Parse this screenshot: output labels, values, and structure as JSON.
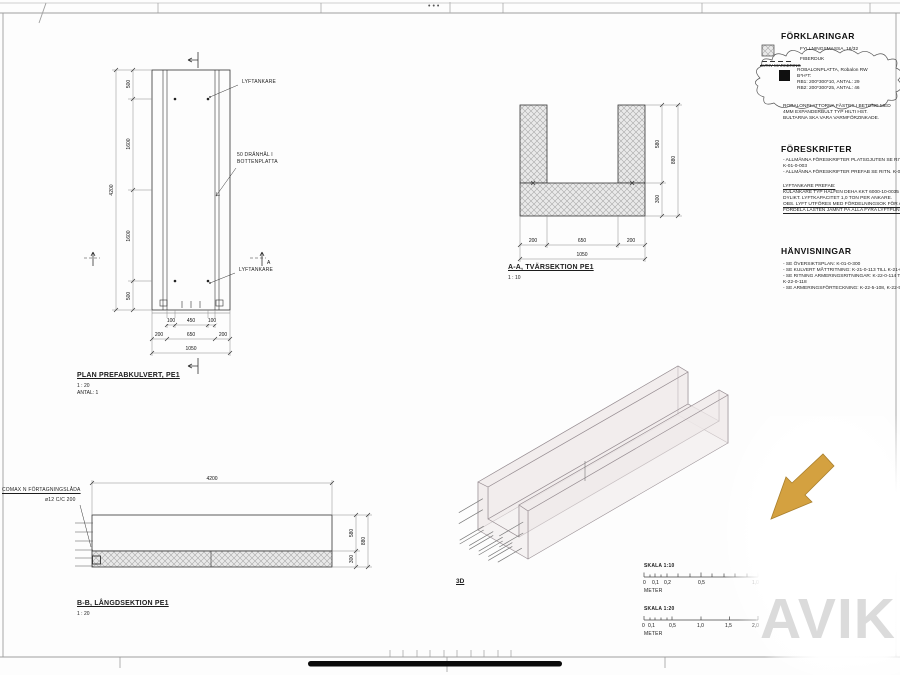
{
  "frame": {
    "dots": "•••"
  },
  "legend": {
    "title": "FÖRKLARINGAR",
    "item1": "FYLLNINGSMASSA, 16/32",
    "item2": "FIBERDUK",
    "struck": "AVRIV MARKERING",
    "cloud_line1": "ROBALONPLATTA, Robalon RW",
    "cloud_line2": "B*H*T:",
    "cloud_line3": "RB1: 200*300*10, ANTAL: 29",
    "cloud_line4": "RB2: 200*300*25, ANTAL: 46",
    "note_line1": "ROBALONPLATTORNA FÄSTES I BETONG MED",
    "note_line2": "4MM EXPANDERBULT TYP HILTI HST.",
    "note_line3": "BULTARNA SKA VARA VARMFÖRZINKADE."
  },
  "foreskrifter": {
    "title": "FÖRESKRIFTER",
    "line1": "- ALLMÄNNA FÖRESKRIFTER PLATSGJUTEN SE RITN.",
    "line2": "K-01-0-003",
    "line3": "- ALLMÄNNA FÖRESKRIFTER PREFAB SE RITN. K-01-0-004",
    "line4": "LYFTANKARE PREFAB:",
    "line5": "KULANKARE TYP HALFEN DEHA KKT 6000-10-0035 FV EL.",
    "line6": "DYLIKT. LYFTKAPACITET 1,0 TON PER ANKARE.",
    "line7": "OBS. LYFT UTFÖRES MED FÖRDELNINGSOK FÖR ATT",
    "line8": "FÖRDELA LASTEN JÄMNT PÅ ALLA FYRA LYFTPUNKTER"
  },
  "hanvisningar": {
    "title": "HÄNVISNINGAR",
    "line1": "- SE ÖVERSIKTSPLAN: K-01-0-300",
    "line2": "- SE KULVERT MÅTTRITNING: K-21-0-113 TILL K-21-0-123",
    "line3": "- SE RITNING ARMERINGSRITNINGAR: K-22-0-114 TILL",
    "line4": "K-22-0-118",
    "line5": "- SE ARMERINGSFÖRTECKNING: K-22-5-108, K-22-5-109"
  },
  "plan": {
    "title": "PLAN PREFABKULVERT, PE1",
    "scale": "1 : 20",
    "antal": "ANTAL: 1",
    "label_lyftankare_1": "LYFTANKARE",
    "label_lyftankare_2": "LYFTANKARE",
    "label_dranhal_1": "50 DRÄNHÅL I",
    "label_dranhal_2": "BOTTENPLATTA",
    "dim_left": [
      "500",
      "1600",
      "1600",
      "500"
    ],
    "dim_left_total": "4200",
    "dim_row1": [
      "100",
      "450",
      "100"
    ],
    "dim_row2": [
      "200",
      "650",
      "200"
    ],
    "dim_total": "1050",
    "marker_a": "A"
  },
  "section_aa": {
    "title": "A-A, TVÄRSEKTION PE1",
    "scale": "1 : 10",
    "dim_right": [
      "580",
      "300"
    ],
    "dim_right_total": "880",
    "dim_bottom": [
      "200",
      "650",
      "200"
    ],
    "dim_bottom_total": "1050"
  },
  "section_bb": {
    "title": "B-B, LÅNGDSEKTION PE1",
    "scale": "1 : 20",
    "dim_top": "4200",
    "dim_right": [
      "580",
      "300"
    ],
    "dim_right_total": "880",
    "label_comax": "COMAX N FÖRTAGNINGSLÅDA",
    "label_rebar": "ø12 C/C 200"
  },
  "view3d": {
    "label": "3D"
  },
  "scalebar10": {
    "title": "SKALA 1:10",
    "labels": [
      "0",
      "0,1",
      "0,2",
      "0,5",
      "1,0"
    ],
    "unit": "METER"
  },
  "scalebar20": {
    "title": "SKALA 1:20",
    "labels": [
      "0",
      "0,1",
      "0,5",
      "1,0",
      "1,5",
      "2,0"
    ],
    "unit": "METER"
  },
  "watermark": {
    "text": "AVIK"
  },
  "colors": {
    "arrow_gold": "#d4a140",
    "watermark_gray": "#dbdbdb",
    "hatch_gray": "#a8a8a8",
    "line": "#333333"
  }
}
